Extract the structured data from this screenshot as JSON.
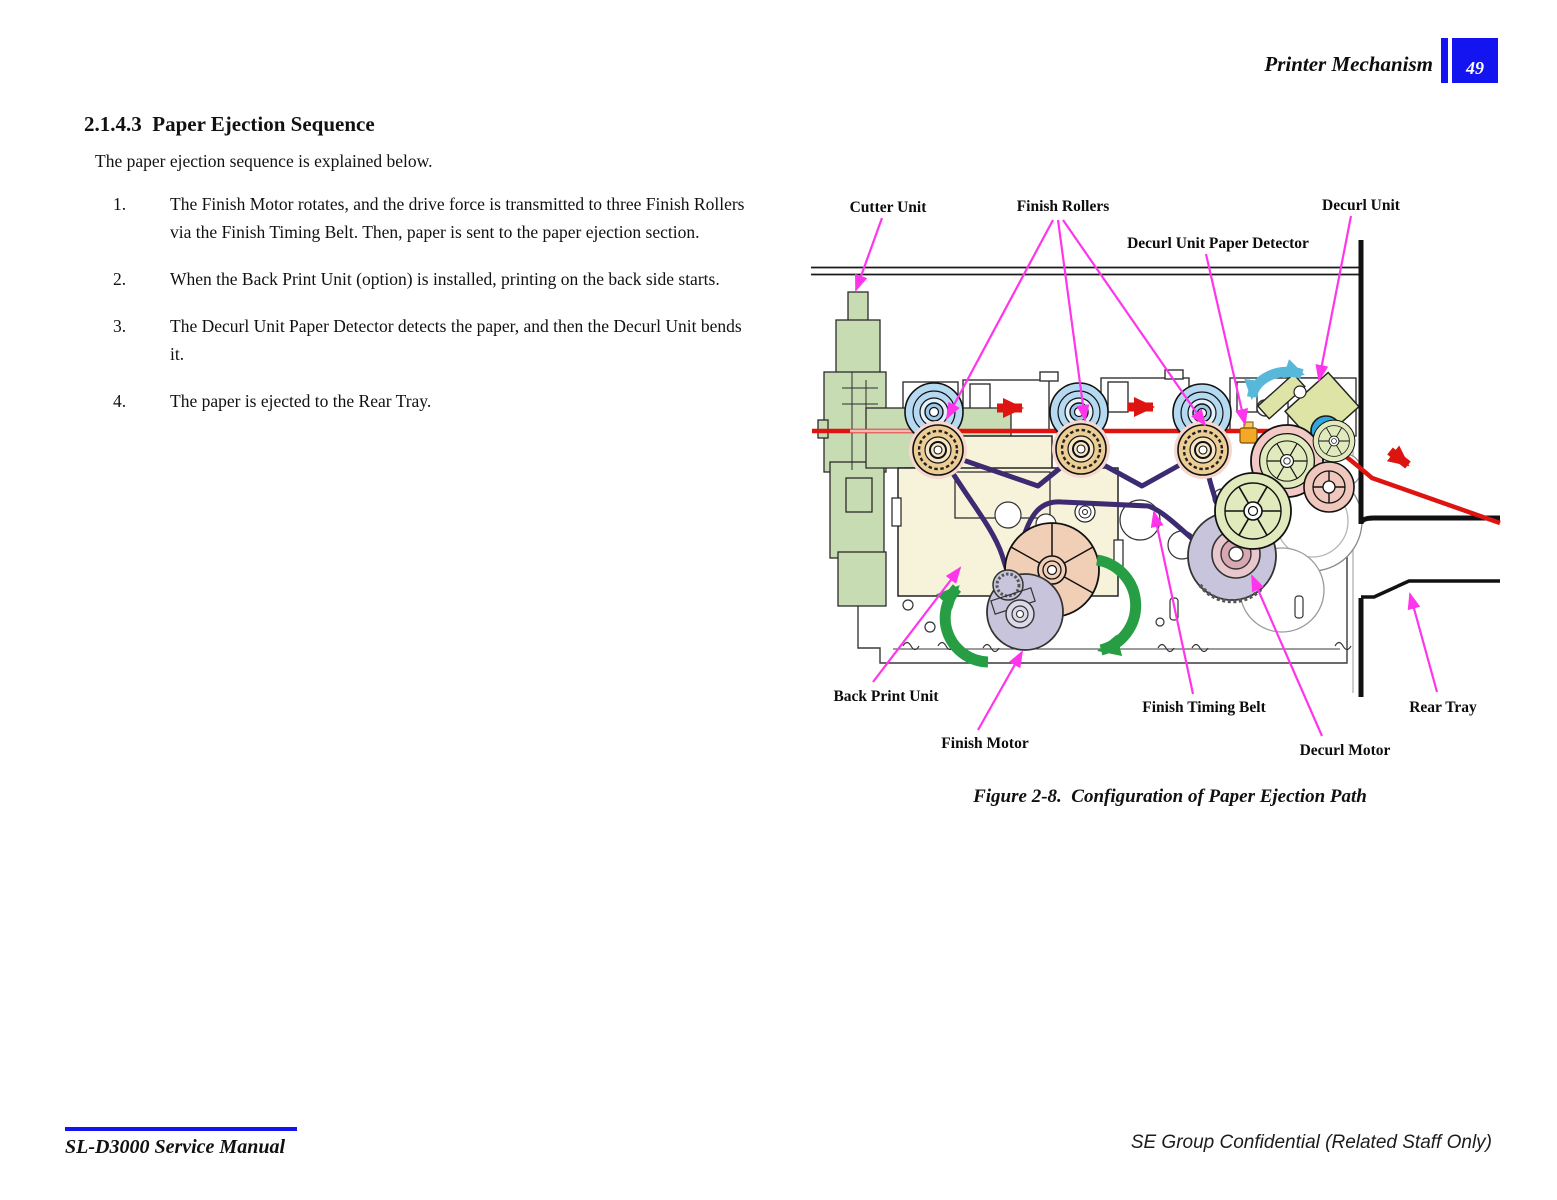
{
  "header": {
    "title": "Printer Mechanism",
    "page_number": "49"
  },
  "section": {
    "heading": "2.1.4.3  Paper Ejection Sequence",
    "intro": "The paper ejection sequence is explained below.",
    "steps": [
      {
        "num": "1.",
        "text": "The Finish Motor rotates, and the drive force is transmitted to three Finish Rollers via the Finish Timing Belt. Then, paper is sent to the paper ejection section."
      },
      {
        "num": "2.",
        "text": "When the Back Print Unit (option) is installed, printing on the back side starts."
      },
      {
        "num": "3.",
        "text": "The Decurl Unit Paper Detector detects the paper, and then the Decurl Unit bends it."
      },
      {
        "num": "4.",
        "text": "The paper is ejected to the Rear Tray."
      }
    ]
  },
  "figure": {
    "caption": "Figure 2-8.  Configuration of Paper Ejection Path",
    "labels": {
      "cutter_unit": "Cutter Unit",
      "finish_rollers": "Finish Rollers",
      "decurl_unit": "Decurl Unit",
      "decurl_detector": "Decurl Unit Paper Detector",
      "back_print_unit": "Back Print Unit",
      "finish_motor": "Finish Motor",
      "finish_timing_belt": "Finish Timing Belt",
      "decurl_motor": "Decurl Motor",
      "rear_tray": "Rear Tray"
    }
  },
  "footer": {
    "manual_title": "SL-D3000 Service Manual",
    "confidential": "SE Group Confidential (Related Staff Only)"
  },
  "colors": {
    "accent_blue": "#1414F0",
    "leader_magenta": "#FF35EC",
    "paper_red": "#DE1410",
    "belt_purple": "#3D2B71",
    "rotation_green": "#279E44",
    "decurl_teal": "#58B8DA"
  }
}
